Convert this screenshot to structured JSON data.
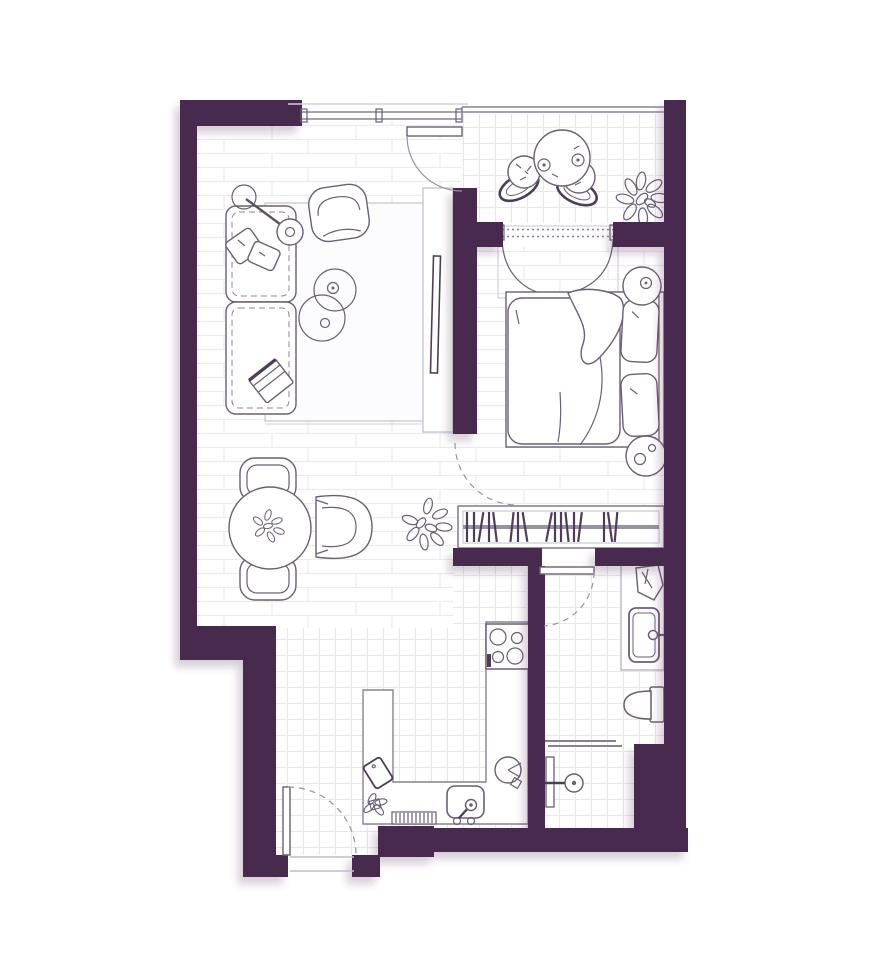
{
  "title": "studio-apartment-floor-plan",
  "colors": {
    "wall": "#482b50",
    "line": "#6a5f73",
    "line_strong": "#4f3c59",
    "frame_light": "#c2bccd",
    "floor_line": "#edeaf2",
    "tile_line": "#eae6f0",
    "rug_border": "#c9c2d2",
    "arc": "#9a91a6",
    "background": "#ffffff",
    "fill": "#ffffff",
    "shadow": "#482b50"
  },
  "rooms": [
    {
      "name": "living-room",
      "floor": "plank",
      "furniture": [
        "sofa",
        "sofa-pillows",
        "throw-blanket",
        "floor-lamp",
        "armchair",
        "rug",
        "coffee-table-large",
        "coffee-table-small",
        "tv-console",
        "tv",
        "potted-plant"
      ]
    },
    {
      "name": "dining-area",
      "floor": "plank",
      "furniture": [
        "dining-table",
        "table-plant",
        "dining-chair-top",
        "dining-chair-bottom",
        "dining-armchair"
      ]
    },
    {
      "name": "balcony",
      "floor": "tile",
      "furniture": [
        "bistro-table",
        "cup-left",
        "cup-right",
        "pouf-chair-left",
        "pouf-chair-right",
        "balcony-plant"
      ]
    },
    {
      "name": "bedroom",
      "floor": "plank",
      "furniture": [
        "curtained-window",
        "double-bed",
        "duvet",
        "folded-duvet-corner",
        "pillow-top",
        "pillow-bottom",
        "bedside-table-top",
        "bedside-table-bottom",
        "bookshelf"
      ]
    },
    {
      "name": "kitchen",
      "floor": "tile",
      "furniture": [
        "u-shaped-counter",
        "stove",
        "kitchen-sink",
        "faucet",
        "dish-rack",
        "cutting-board",
        "basket",
        "door-mat"
      ]
    },
    {
      "name": "bathroom",
      "floor": "tile",
      "furniture": [
        "vanity-counter",
        "towel",
        "washbasin",
        "basin-faucet",
        "toilet",
        "shower-partition",
        "shower-column",
        "shower-head"
      ]
    },
    {
      "name": "entry",
      "floor": "tile",
      "furniture": [
        "entry-door"
      ]
    }
  ],
  "doors": [
    "balcony-door",
    "bedroom-door",
    "bathroom-door",
    "entry-door"
  ],
  "windows": [
    "living-room-window",
    "balcony-glazing",
    "bedroom-balcony-window"
  ]
}
